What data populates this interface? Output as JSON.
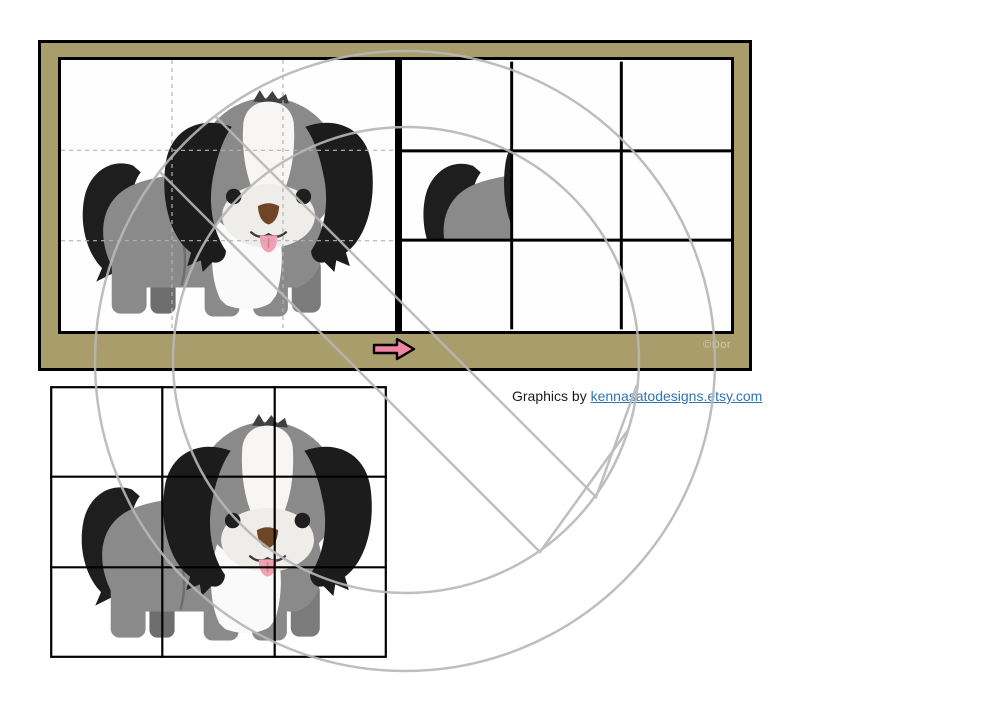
{
  "window": {
    "width": 1000,
    "height": 707,
    "background": "#ffffff"
  },
  "board": {
    "background_color": "#a89d6b",
    "border_color": "#000000",
    "copyright_label": "©Dor",
    "copyright_color": "#cfc9ad",
    "arrow": {
      "icon": "right-arrow-icon",
      "fill": "#ef85a0",
      "outline": "#000000"
    },
    "model_panel": {
      "content": "complete gray-and-white puppy picture",
      "grid_rows": 3,
      "grid_cols": 3,
      "grid_line_style": "dashed",
      "grid_line_color": "#b3b3b3"
    },
    "assembly_panel": {
      "content": "empty 3x3 answer grid with one puzzle piece placed",
      "grid_rows": 3,
      "grid_cols": 3,
      "grid_line_style": "solid",
      "grid_line_color": "#000000",
      "placed_piece_cell": "row 2, column 1",
      "placed_piece": "puppy tail and back"
    }
  },
  "credit": {
    "prefix": "Graphics by ",
    "link_text": "kennasatodesigns.etsy.com",
    "link_color": "#2e74b5"
  },
  "cut_grid": {
    "content": "full puppy picture overlaid with solid 3x3 cutting grid",
    "grid_rows": 3,
    "grid_cols": 3,
    "grid_line_color": "#000000"
  },
  "puppy": {
    "name": "gray-and-white-puppy",
    "body_color": "#8a8a8a",
    "ear_color": "#1c1c1c",
    "tail_color": "#1e1e1e",
    "blaze_color": "#f7f6f4",
    "muzzle_color": "#efede9",
    "nose_color": "#6f4527",
    "tongue_color": "#f2a0b4"
  },
  "watermark": {
    "shape": "two concentric circles with double bent diagonal slash",
    "color": "#b7b7b7"
  }
}
